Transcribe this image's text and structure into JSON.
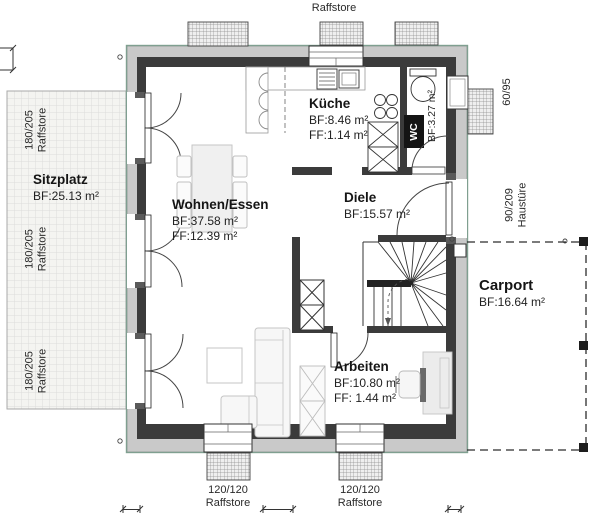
{
  "plan_title": "floor-plan-ground-floor",
  "rooms": {
    "sitzplatz": {
      "name": "Sitzplatz",
      "bf": "BF:25.13 m²"
    },
    "wohnen": {
      "name": "Wohnen/Essen",
      "bf": "BF:37.58 m²",
      "ff": "FF:12.39 m²"
    },
    "kueche": {
      "name": "Küche",
      "bf": "BF:8.46 m²",
      "ff": "FF:1.14 m²"
    },
    "diele": {
      "name": "Diele",
      "bf": "BF:15.57 m²"
    },
    "wc": {
      "name": "WC",
      "bf": "BF:3.27 m²"
    },
    "arbeiten": {
      "name": "Arbeiten",
      "bf": "BF:10.80 m²",
      "ff": "FF: 1.44 m²"
    },
    "carport": {
      "name": "Carport",
      "bf": "BF:16.64 m²"
    }
  },
  "windows": {
    "left": [
      {
        "size": "180/205",
        "type": "Raffstore"
      },
      {
        "size": "180/205",
        "type": "Raffstore"
      },
      {
        "size": "180/205",
        "type": "Raffstore"
      }
    ],
    "top": {
      "size": "120/120",
      "type": "Raffstore"
    },
    "bottom": [
      {
        "size": "120/120",
        "type": "Raffstore"
      },
      {
        "size": "120/120",
        "type": "Raffstore"
      }
    ],
    "right_small": {
      "size": "60/95"
    },
    "entry": {
      "size": "90/209",
      "type": "Haustüre"
    }
  },
  "colors": {
    "wall": "#3b3b3b",
    "insulation": "#c9c9c9",
    "outline_teal": "#7f9f90",
    "hatch": "#909090"
  }
}
